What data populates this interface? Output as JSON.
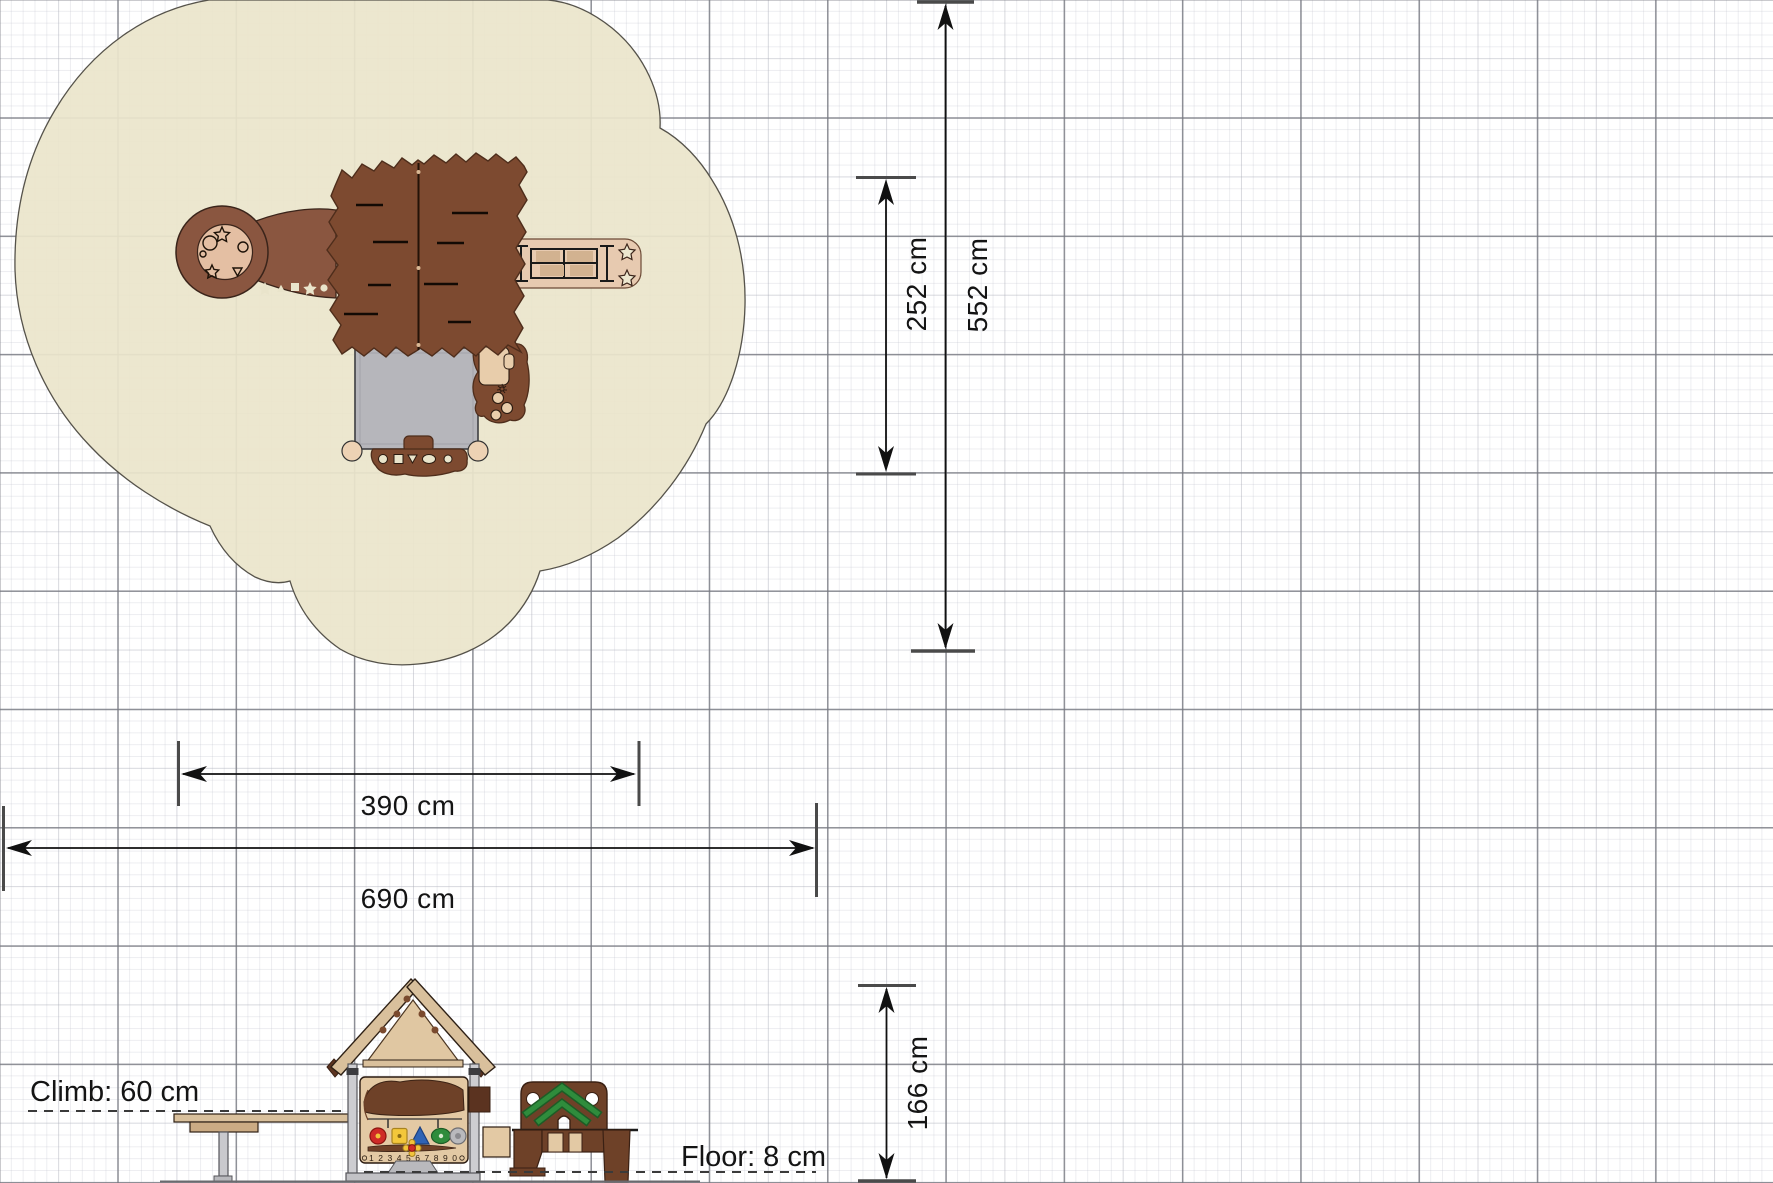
{
  "drawing": {
    "type": "playground equipment technical drawing",
    "views": {
      "plan": "top view with safety zone",
      "elevation": "side view"
    }
  },
  "dims": {
    "w390": "390 cm",
    "w690": "690 cm",
    "h252": "252 cm",
    "h552": "552 cm",
    "h166": "166 cm"
  },
  "labels": {
    "climb": "Climb: 60 cm",
    "floor": "Floor: 8 cm",
    "panel_numbers": "1 2 3 4 5 6 7 8 9 0"
  },
  "colors": {
    "safety_zone": "#ebe5cb",
    "equipment_brown": "#7d4a30",
    "ring_brown": "#8a5640",
    "platform_tan": "#e4bfa3",
    "roof_gray": "#b6b6bb",
    "bench_tan": "#e7cab0",
    "wood_tan": "#d9c09c",
    "panel_tan": "#e3c9a4",
    "accent_red": "#cf2b27",
    "accent_yellow": "#f2c33b",
    "accent_blue": "#2f63b5",
    "accent_green": "#2f8c3c",
    "grid_major": "#767880"
  }
}
